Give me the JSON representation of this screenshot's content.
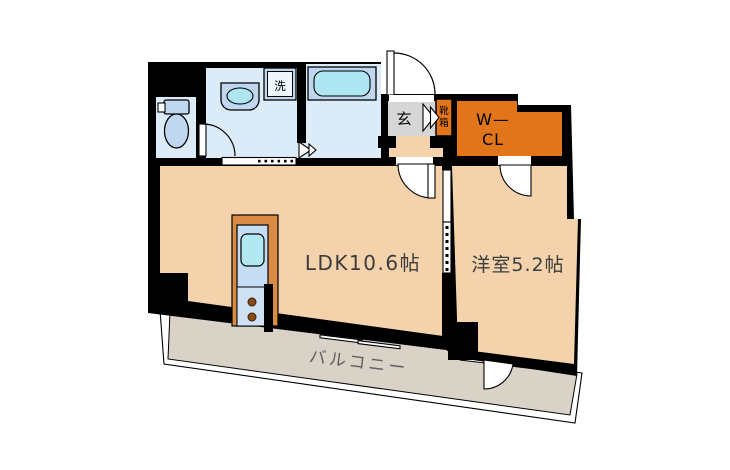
{
  "labels": {
    "ldk": "LDK10.6帖",
    "western_room": "洋室5.2帖",
    "balcony": "バルコニー",
    "entrance": "玄",
    "laundry": "洗",
    "wcl_line1": "W—",
    "wcl_line2": "CL",
    "shoe_char1": "靴",
    "shoe_char2": "箱"
  },
  "colors": {
    "wall": "#000000",
    "room_floor": "#f3d2ac",
    "wet_area_floor": "#dcebf8",
    "fixture_blue": "#bfd8f0",
    "fixture_inner_cyan": "#aee6f2",
    "sink_cyan": "#b2e8f2",
    "closet_orange": "#e2741a",
    "kitchen_counter_orange": "#d98b45",
    "entrance_gray": "#d6d6d6",
    "balcony_gray": "#d9d2c7",
    "stove_burner_brown": "#8a4a16",
    "label_dark": "#3c3c3c",
    "balcony_label_gray": "#606060"
  }
}
